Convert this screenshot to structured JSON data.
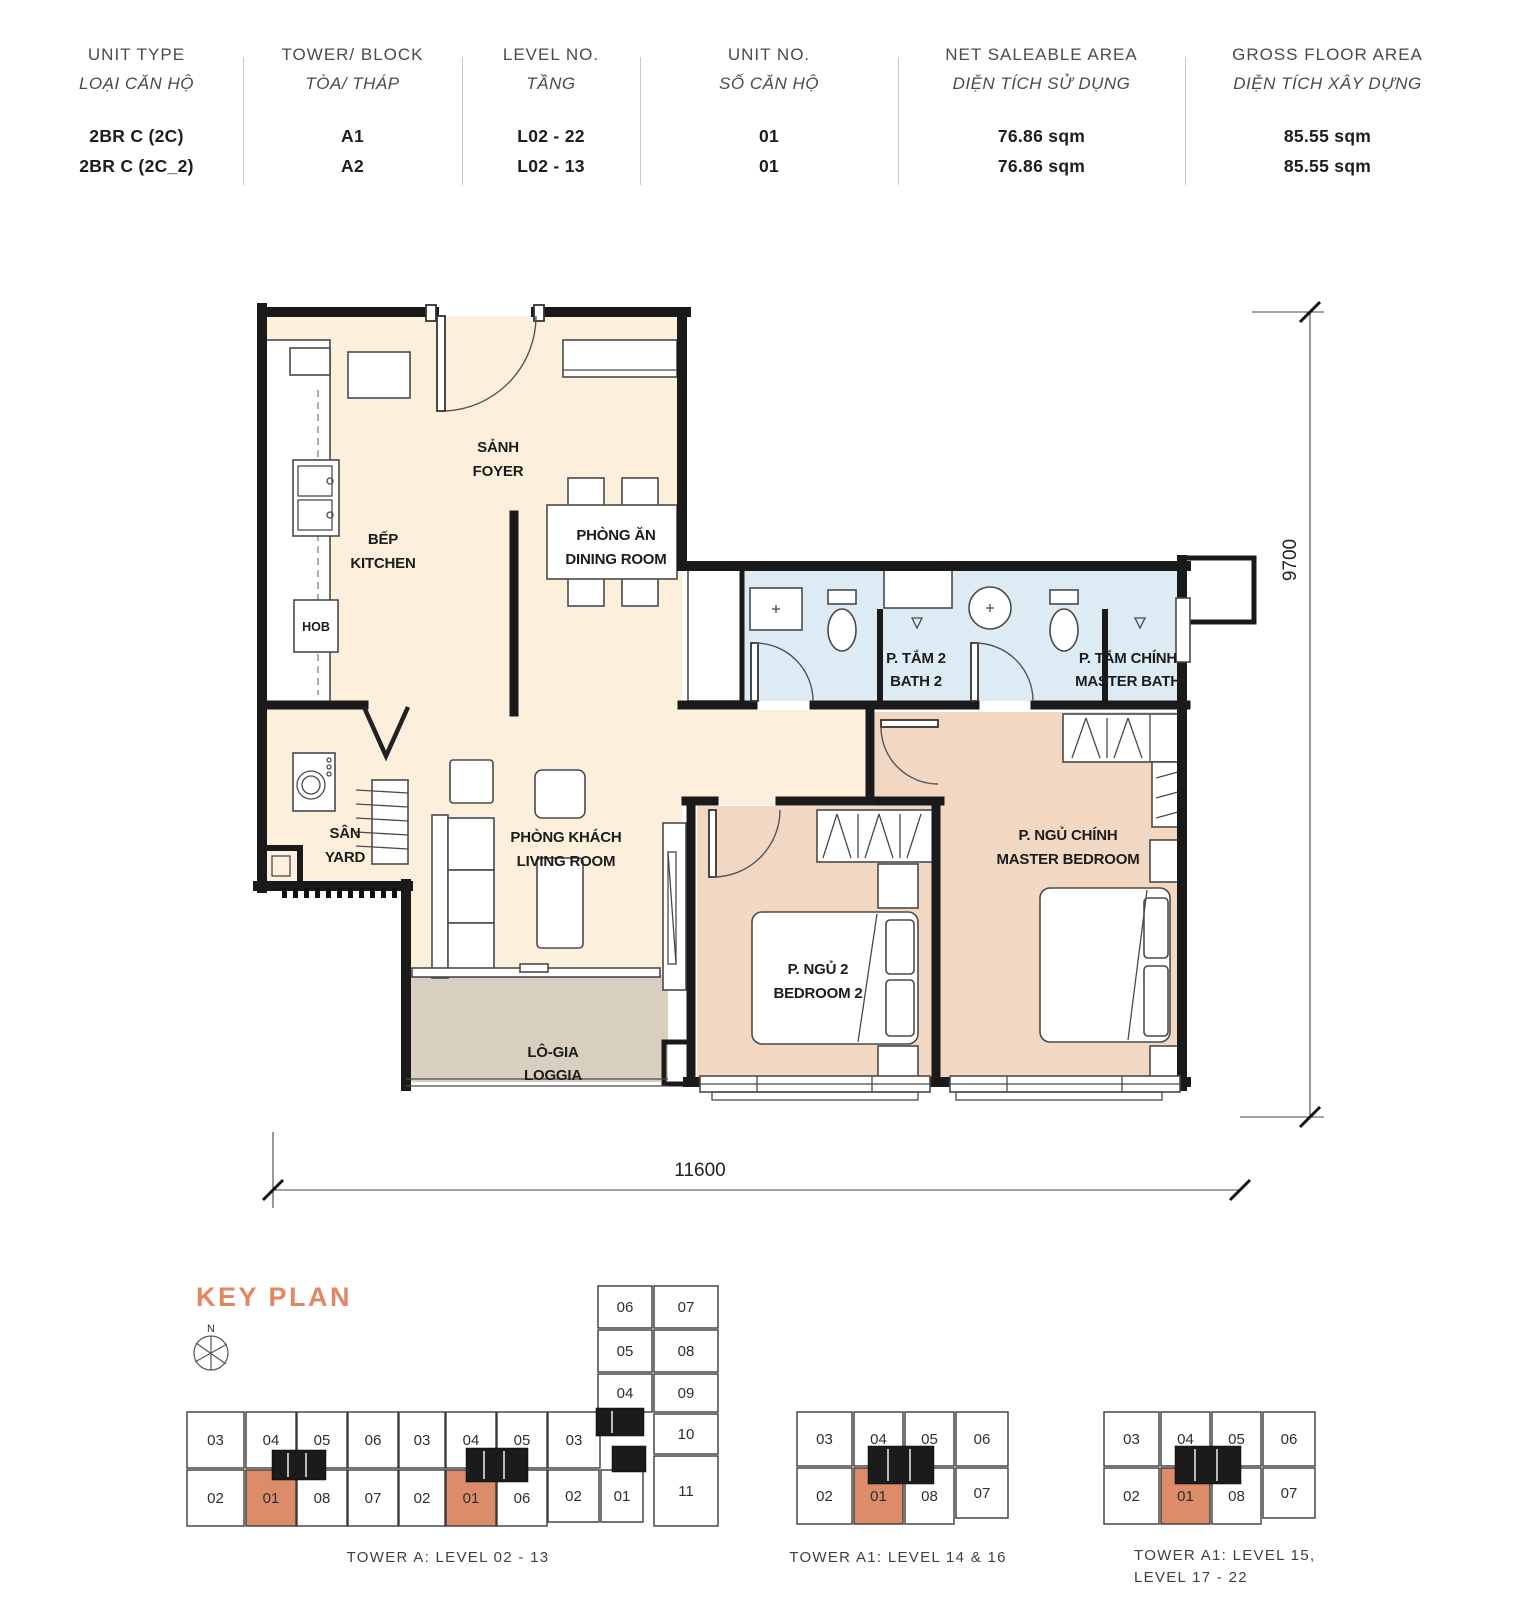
{
  "header": {
    "columns": [
      {
        "en": "UNIT TYPE",
        "vi": "LOẠI CĂN HỘ",
        "values": [
          "2BR C (2C)",
          "2BR C (2C_2)"
        ]
      },
      {
        "en": "TOWER/ BLOCK",
        "vi": "TÒA/ THÁP",
        "values": [
          "A1",
          "A2"
        ]
      },
      {
        "en": "LEVEL NO.",
        "vi": "TẦNG",
        "values": [
          "L02 - 22",
          "L02 - 13"
        ]
      },
      {
        "en": "UNIT NO.",
        "vi": "SỐ CĂN HỘ",
        "values": [
          "01",
          "01"
        ]
      },
      {
        "en": "NET SALEABLE AREA",
        "vi": "DIỆN TÍCH SỬ DỤNG",
        "values": [
          "76.86 sqm",
          "76.86 sqm"
        ]
      },
      {
        "en": "GROSS FLOOR AREA",
        "vi": "DIỆN TÍCH XÂY DỰNG",
        "values": [
          "85.55 sqm",
          "85.55 sqm"
        ]
      }
    ]
  },
  "floorplan": {
    "rooms": {
      "foyer": {
        "vi": "SẢNH",
        "en": "FOYER"
      },
      "kitchen": {
        "vi": "BẾP",
        "en": "KITCHEN"
      },
      "dining": {
        "vi": "PHÒNG ĂN",
        "en": "DINING ROOM"
      },
      "bath2": {
        "vi": "P. TẮM 2",
        "en": "BATH 2"
      },
      "master_bath": {
        "vi": "P. TẮM CHÍNH",
        "en": "MASTER BATH"
      },
      "yard": {
        "vi": "SÂN",
        "en": "YARD"
      },
      "living": {
        "vi": "PHÒNG KHÁCH",
        "en": "LIVING ROOM"
      },
      "bedroom2": {
        "vi": "P. NGỦ 2",
        "en": "BEDROOM 2"
      },
      "master_bedroom": {
        "vi": "P. NGỦ CHÍNH",
        "en": "MASTER BEDROOM"
      },
      "loggia": {
        "vi": "LÔ-GIA",
        "en": "LOGGIA"
      }
    },
    "hob": "HOB",
    "dim_width": "11600",
    "dim_height": "9700",
    "colors": {
      "floor_main": "#FCF0DC",
      "floor_bedroom": "#F2D8C3",
      "floor_bath": "#DDEBF4",
      "floor_loggia": "#D8CFC1",
      "wall": "#1A1A1A"
    }
  },
  "keyplan": {
    "title": "KEY PLAN",
    "compass_label": "N",
    "colors": {
      "highlight": "#DD8C69",
      "title": "#E28764"
    },
    "plans": [
      {
        "caption": "TOWER A: LEVEL 02 - 13",
        "caption2": "",
        "cells": {
          "strip_top": [
            {
              "n": "03",
              "hl": false
            },
            {
              "n": "04",
              "hl": false
            },
            {
              "n": "05",
              "hl": false
            },
            {
              "n": "06",
              "hl": false
            },
            {
              "n": "03",
              "hl": false
            },
            {
              "n": "04",
              "hl": false
            },
            {
              "n": "05",
              "hl": false
            },
            {
              "n": "03",
              "hl": false
            }
          ],
          "strip_bottom": [
            {
              "n": "02",
              "hl": false
            },
            {
              "n": "01",
              "hl": true
            },
            {
              "n": "08",
              "hl": false
            },
            {
              "n": "07",
              "hl": false
            },
            {
              "n": "02",
              "hl": false
            },
            {
              "n": "01",
              "hl": true
            },
            {
              "n": "06",
              "hl": false
            },
            {
              "n": "02",
              "hl": false
            },
            {
              "n": "01",
              "hl": false
            }
          ],
          "wing_left": [
            {
              "n": "06",
              "hl": false
            },
            {
              "n": "05",
              "hl": false
            },
            {
              "n": "04",
              "hl": false
            }
          ],
          "wing_right": [
            {
              "n": "07",
              "hl": false
            },
            {
              "n": "08",
              "hl": false
            },
            {
              "n": "09",
              "hl": false
            },
            {
              "n": "10",
              "hl": false
            },
            {
              "n": "11",
              "hl": false
            }
          ]
        }
      },
      {
        "caption": "TOWER A1: LEVEL 14 & 16",
        "caption2": "",
        "cells": {
          "top": [
            {
              "n": "03",
              "hl": false
            },
            {
              "n": "04",
              "hl": false
            },
            {
              "n": "05",
              "hl": false
            },
            {
              "n": "06",
              "hl": false
            }
          ],
          "bottom": [
            {
              "n": "02",
              "hl": false
            },
            {
              "n": "01",
              "hl": true
            },
            {
              "n": "08",
              "hl": false
            },
            {
              "n": "07",
              "hl": false
            }
          ]
        }
      },
      {
        "caption": "TOWER A1: LEVEL 15,",
        "caption2": "LEVEL 17 - 22",
        "cells": {
          "top": [
            {
              "n": "03",
              "hl": false
            },
            {
              "n": "04",
              "hl": false
            },
            {
              "n": "05",
              "hl": false
            },
            {
              "n": "06",
              "hl": false
            }
          ],
          "bottom": [
            {
              "n": "02",
              "hl": false
            },
            {
              "n": "01",
              "hl": true
            },
            {
              "n": "08",
              "hl": false
            },
            {
              "n": "07",
              "hl": false
            }
          ]
        }
      }
    ]
  }
}
